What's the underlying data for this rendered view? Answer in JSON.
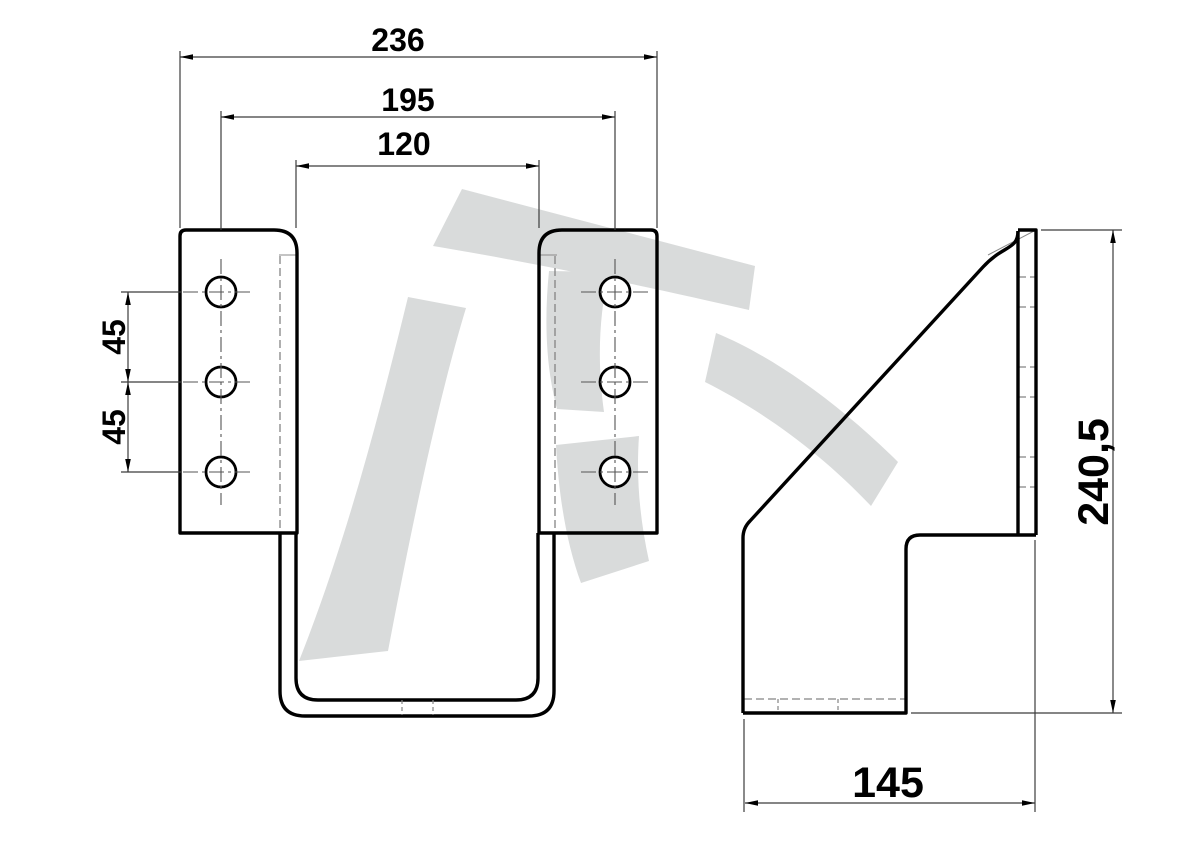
{
  "title": "Technical drawing of bent-plate bracket, two views",
  "drawing": {
    "background_color": "#ffffff",
    "outline_color": "#000000",
    "thin_line_color": "#4a4a4a",
    "hidden_line_color": "#848484",
    "watermark_color": "#d9dbdb",
    "views": {
      "front": {
        "dimensions": {
          "total_width": "236",
          "hole_span": "195",
          "inner_width": "120",
          "hole_pitch_upper": "45",
          "hole_pitch_lower": "45"
        }
      },
      "side": {
        "dimensions": {
          "height": "240,5",
          "depth": "145"
        }
      }
    }
  }
}
